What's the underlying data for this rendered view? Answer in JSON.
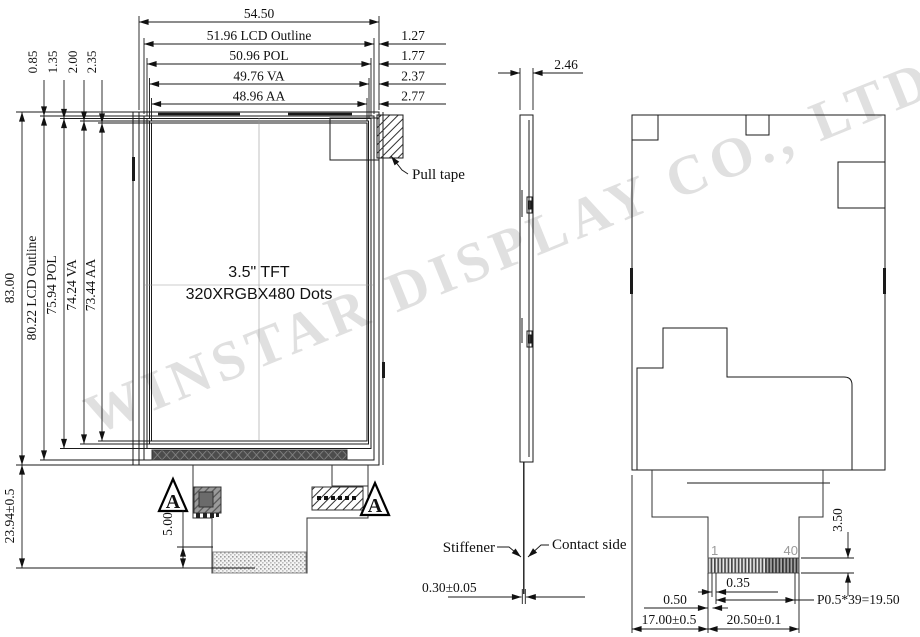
{
  "watermark": "WINSTAR DISPLAY CO., LTD.",
  "front_view": {
    "dim_total_width": "54.50",
    "width_dims": [
      {
        "label": "51.96 LCD Outline",
        "edge_gap": "1.27"
      },
      {
        "label": "50.96 POL",
        "edge_gap": "1.77"
      },
      {
        "label": "49.76 VA",
        "edge_gap": "2.37"
      },
      {
        "label": "48.96 AA",
        "edge_gap": "2.77"
      }
    ],
    "top_edge_dims": [
      "0.85",
      "1.35",
      "2.00",
      "2.35"
    ],
    "height_dims": [
      "83.00",
      "80.22 LCD Outline",
      "75.94 POL",
      "74.24 VA",
      "73.44 AA"
    ],
    "fpc_length_dim": "23.94±0.5",
    "fpc_tail_dim": "5.00",
    "display_title": "3.5\" TFT",
    "display_resolution": "320XRGBX480 Dots",
    "pull_tape_label": "Pull tape",
    "section_marker": "A"
  },
  "side_view": {
    "thickness_dim": "2.46",
    "stiffener_label": "Stiffener",
    "contact_side_label": "Contact side",
    "fpc_thickness_dim": "0.30±0.05"
  },
  "rear_view": {
    "connector_height_dim": "3.50",
    "pin_width_dim": "0.35",
    "pin_offset_dim": "0.50",
    "pitch_dim": "P0.5*39=19.50",
    "left_offset_dim": "17.00±0.5",
    "connector_width_dim": "20.50±0.1",
    "pin_first": "1",
    "pin_last": "40"
  }
}
